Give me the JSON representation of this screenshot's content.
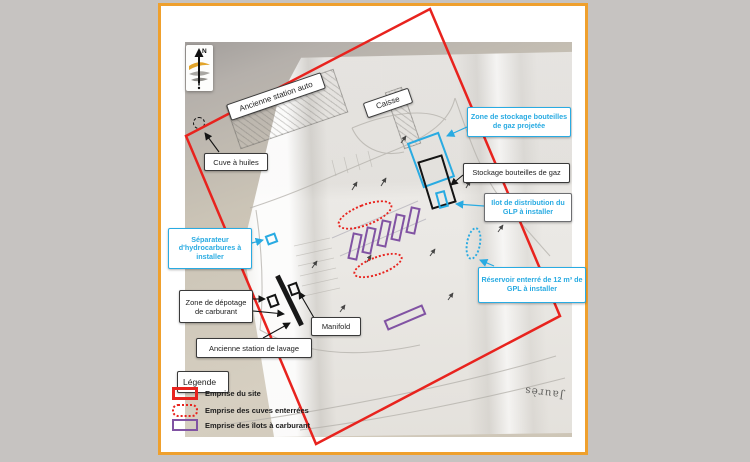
{
  "colors": {
    "frame_orange": "#efa02d",
    "site_red": "#e8231e",
    "cyan": "#29abe2",
    "purple": "#8153a3",
    "outer_gray": "#c6c3c1"
  },
  "compass": {
    "north": "N"
  },
  "plan_labels": {
    "station_auto": "Ancienne station auto",
    "caisse": "Caisse",
    "cuve_huiles": "Cuve à huiles",
    "zone_stockage_gaz": "Zone de stockage bouteilles de gaz projetée",
    "stockage_gaz": "Stockage bouteilles de gaz",
    "ilot_glp": "Ilot de distribution du GLP à installer",
    "separateur": "Séparateur d'hydrocarbures à installer",
    "reservoir": "Réservoir enterré de 12 m³ de GPL à installer",
    "zone_depotage": "Zone de dépotage de carburant",
    "manifold": "Manifold",
    "station_lavage": "Ancienne station de lavage"
  },
  "legend": {
    "title": "Légende",
    "items": [
      {
        "label": "Emprise du site",
        "style": "red-solid"
      },
      {
        "label": "Emprise des cuves enterrées",
        "style": "red-dotted"
      },
      {
        "label": "Emprise des îlots à carburant",
        "style": "purple-solid"
      }
    ]
  },
  "map_annotations": {
    "street_name": "Jaurès"
  }
}
